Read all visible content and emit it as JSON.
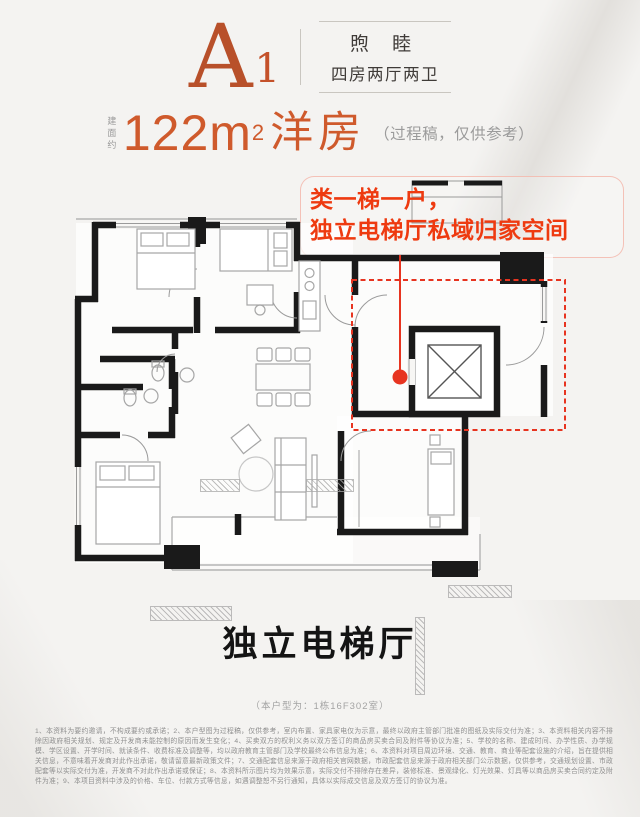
{
  "palette": {
    "accent_serif": "#b8502a",
    "accent_orange": "#cf5a2c",
    "accent_red": "#ee3a10",
    "marker_red": "#e73420",
    "wall_black": "#1a1a1a",
    "page_bg": "#f4f3f1"
  },
  "header": {
    "plan_letter": "A",
    "plan_index": "1",
    "name": "煦 睦",
    "layout": "四房两厅两卫"
  },
  "area": {
    "prefix": "建面约",
    "value": "122m",
    "sup": "2",
    "type": "洋房",
    "note": "（过程稿，仅供参考）"
  },
  "callout": {
    "line1": "类一梯一户，",
    "line2": "独立电梯厅私域归家空间"
  },
  "caption": {
    "title": "独立电梯厅",
    "unit_note": "（本户型为：1栋16F302室）"
  },
  "disclaimer": {
    "text": "1、本资料为要约邀请，不构成要约或承诺；2、本户型图为过程稿，仅供参考，室内布置、家具家电仅为示意，最终以政府主管部门批准的图纸及实际交付为准；3、本资料相关内容不排除因政府相关规划、规定及开发商未能控制的原因而发生变化；4、买卖双方的权利义务以双方签订的商品房买卖合同及附件等协议为准；5、学校的名称、建成时间、办学性质、办学规模、学区设置、开学时间、就读条件、收费标准及调整等，均以政府教育主管部门及学校最终公布信息为准；6、本资料对项目周边环境、交通、教育、商业等配套设施的介绍，旨在提供相关信息，不意味着开发商对此作出承诺，敬请留意最新政策文件；7、交通配套信息来源于政府相关官网数据，市政配套信息来源于政府相关部门公示数据，仅供参考，交通规划设置、市政配套等以实际交付为准，开发商不对此作出承诺或保证；8、本资料所示图片均为效果示意，实际交付不排除存在差异，装修标准、景观绿化、灯光效果、灯具等以商品房买卖合同约定及附件为准；9、本项目资料中涉及的价格、车位、付款方式等信息，如遇调整恕不另行通知，具体以实际成交信息及双方签订的协议为准。"
  }
}
